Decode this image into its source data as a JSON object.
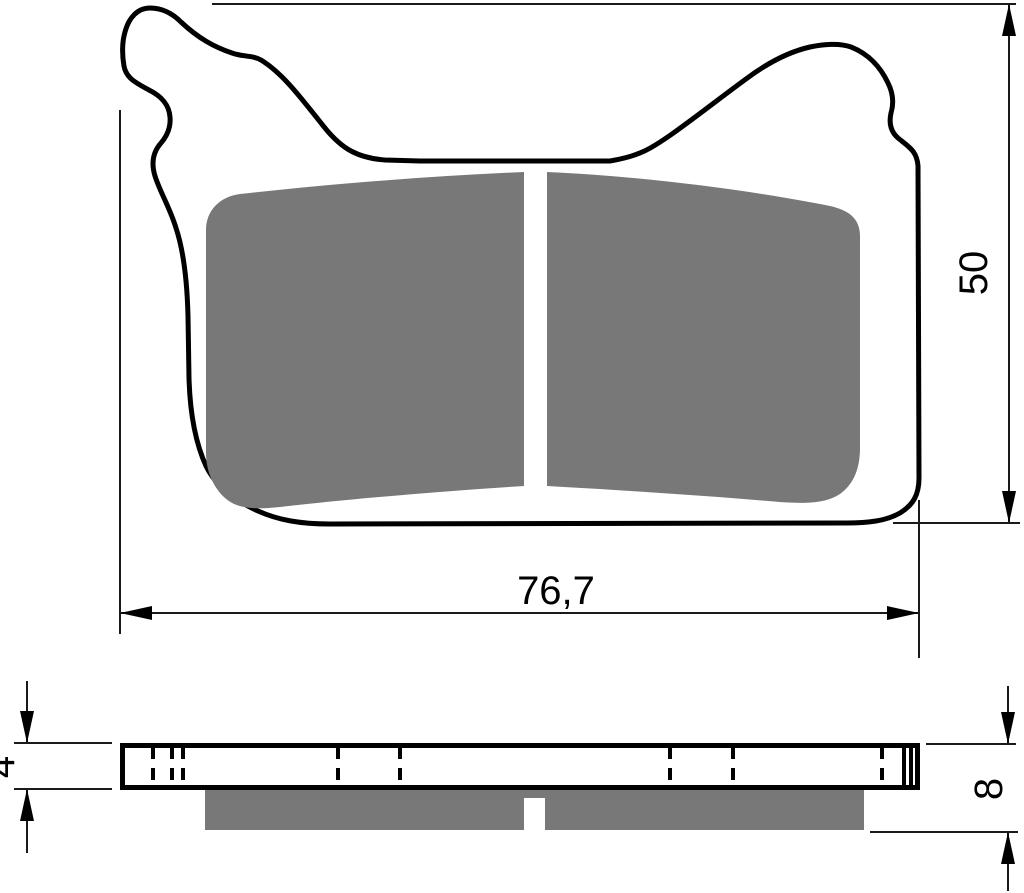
{
  "drawing": {
    "views": {
      "top_view": "brake-pad-face-view",
      "side_view": "brake-pad-profile-view"
    },
    "labels": {
      "width": "76,7",
      "height": "50",
      "plate_thickness": "4",
      "total_thickness": "8"
    },
    "colors": {
      "outline": "#000000",
      "friction": "#787878",
      "background": "#ffffff",
      "dimension": "#1a1a1a"
    }
  }
}
